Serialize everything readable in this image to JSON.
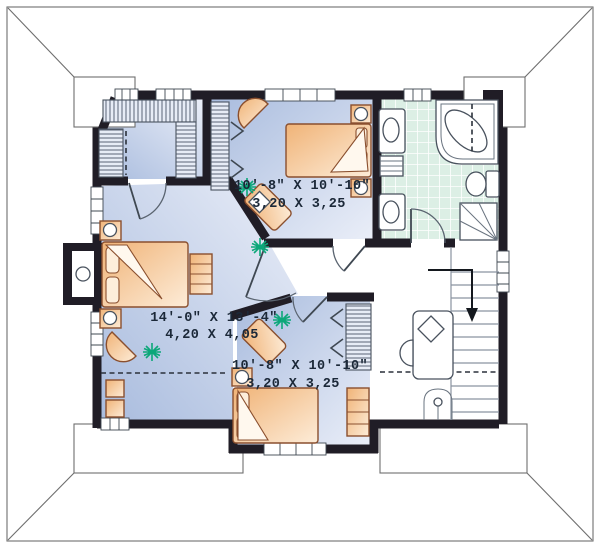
{
  "rooms": {
    "bedroom_top": {
      "imperial": "10'-8\" X 10'-10\"",
      "metric": "3,20 X 3,25"
    },
    "master_bedroom": {
      "imperial": "14'-0\" X 13'-4\"",
      "metric": "4,20 X 4,05"
    },
    "bedroom_bottom": {
      "imperial": "10'-8\" X 10'-10\"",
      "metric": "3,20 X 3,25"
    }
  },
  "icons": {
    "stairs": "down-arrow",
    "plants": "plant-starburst"
  },
  "colors": {
    "wall": "#201d26",
    "line": "#6e6e6e",
    "floor1": "#a9bcde",
    "floor2": "#eaeef8",
    "tile": "#dcefe5",
    "furn1": "#f0b377",
    "furn2": "#fdecd8",
    "furnline": "#8a4f2e",
    "plant": "#0ca779"
  }
}
